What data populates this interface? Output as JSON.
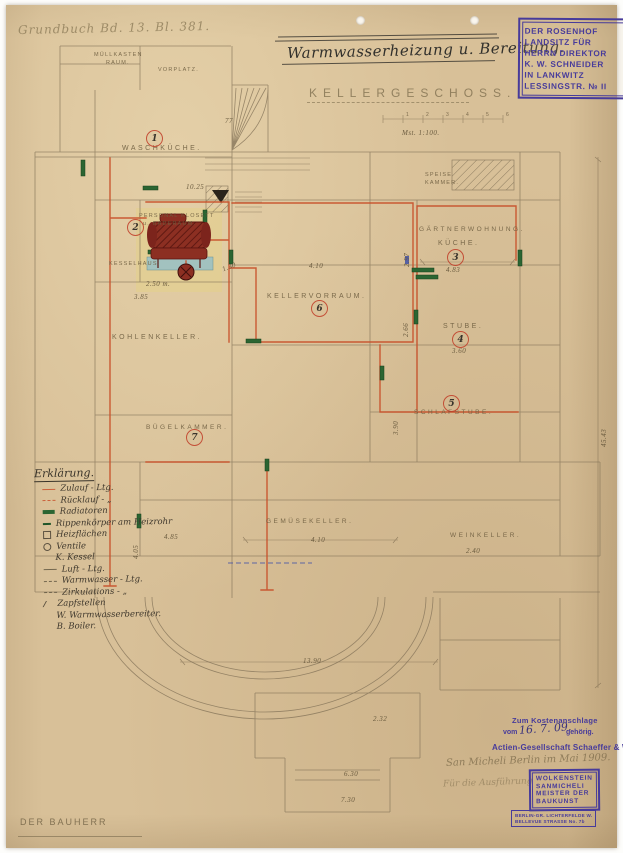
{
  "page": {
    "grundbuch_note": "Grundbuch Bd. 13. Bl. 381.",
    "title": "Warmwasserheizung u. Bereitung.",
    "floor_label": "KELLERGESCHOSS.",
    "scale_note": "Mst. 1:100.",
    "scale_ticks": [
      "1",
      "2",
      "3",
      "4",
      "5",
      "6"
    ],
    "bauherr_label": "DER BAUHERR"
  },
  "owner_stamp": {
    "lines": [
      "DER ROSENHOF",
      "LANDSITZ FÜR",
      "HERRN DIREKTOR",
      "K. W. SCHNEIDER",
      "IN LANKWITZ",
      "LESSINGSTR. № II"
    ]
  },
  "rooms": {
    "muellkasten": {
      "line1": "MÜLLKASTEN",
      "line2": "RAUM."
    },
    "vorplatz": {
      "label": "VORPLATZ."
    },
    "waschkueche": {
      "number": "1",
      "label": "WASCHKÜCHE."
    },
    "personal_klosett": {
      "number": "2",
      "line1": "PERSONAL KLOSETT",
      "line2": "u. BADERAUM."
    },
    "kesselhaus": {
      "label": "KESSELHAUS."
    },
    "speisekammer": {
      "line1": "SPEISE",
      "line2": "KAMMER."
    },
    "gaertnerwohnung": {
      "label": "GÄRTNERWOHNUNG."
    },
    "kueche": {
      "number": "3",
      "label": "KÜCHE."
    },
    "stube": {
      "number": "4",
      "label": "STUBE."
    },
    "schlafstube": {
      "number": "5",
      "label": "SCHLAFSTUBE."
    },
    "kellervorraum": {
      "number": "6",
      "label": "KELLERVORRAUM."
    },
    "buegelkammer": {
      "number": "7",
      "label": "BÜGELKAMMER."
    },
    "kohlenkeller": {
      "label": "KOHLENKELLER."
    },
    "gemuesekeller": {
      "label": "GEMÜSEKELLER."
    },
    "weinkeller": {
      "label": "WEINKELLER."
    }
  },
  "dimensions": {
    "d410a": "4.10",
    "d483": "4.83",
    "d297": "2.97",
    "d360": "3.60",
    "d266": "2.66",
    "d390": "3.90",
    "d410b": "4.10",
    "d240": "2.40",
    "d485": "4.85",
    "d250": "2.50 m.",
    "d130": "1.30",
    "d385": "3.85",
    "d1025": "10.25",
    "d1390": "13.90",
    "d4543": "45.43",
    "d630": "6.30",
    "d730": "7.30",
    "d232": "2.32",
    "d405": "4.05",
    "d77": "77"
  },
  "legend": {
    "heading": "Erklärung.",
    "entries": [
      {
        "label": "Zulauf - Ltg."
      },
      {
        "label": "Rücklauf -  „"
      },
      {
        "label": "Radiatoren"
      },
      {
        "label": "Rippenkörper am Heizrohr"
      },
      {
        "label": "Heizflächen"
      },
      {
        "label": "Ventile"
      },
      {
        "label": "K. Kessel"
      },
      {
        "label": "Luft - Ltg."
      },
      {
        "label": "Warmwasser - Ltg."
      },
      {
        "label": "Zirkulations -  „"
      },
      {
        "label": "Zapfstellen"
      },
      {
        "label": "W. Warmwasserbereiter."
      },
      {
        "label": "B. Boiler."
      }
    ]
  },
  "approval": {
    "kosten_line1": "Zum Kostenanschlage",
    "kosten_pre": "vom",
    "kosten_date": "16. 7. 09.",
    "kosten_post": "gehörig.",
    "firm_stamp": "Actien-Gesellschaft Schaeffer & Walcker",
    "pencil_note1": "San Micheli   Berlin im Mai 1909.",
    "pencil_note2": "Für die Ausführung",
    "architect_stamp": {
      "lines": [
        "WOLKENSTEIN",
        "SANMICHELI",
        "MEISTER DER",
        "BAUKUNST"
      ]
    },
    "address_stamp": {
      "lines": [
        "BERLIN-GR. LICHTERFELDE W.",
        "BELLEVUE STRASSE No. 7b"
      ]
    }
  },
  "colors": {
    "paper": "#d8c098",
    "pipe_red": "#c8502a",
    "radiator_green": "#2b6532",
    "stamp_purple": "#473b9b",
    "boiler_red": "#7c241c",
    "wash_teal": "#9cc1c4",
    "wash_yellow": "#e6d37f"
  }
}
